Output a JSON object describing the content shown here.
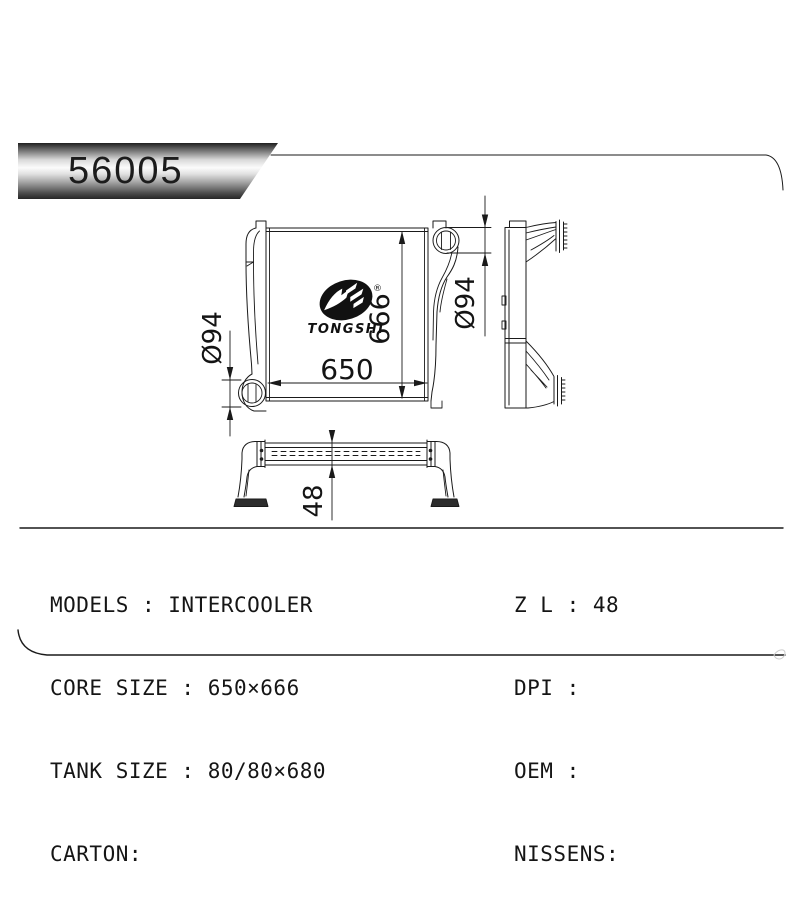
{
  "banner": {
    "part_number": "56005"
  },
  "logo": {
    "brand": "TONGSHI",
    "registered_mark": "®"
  },
  "drawing": {
    "dim_core_width": "650",
    "dim_core_height": "666",
    "dim_left_port_diameter": "Ø94",
    "dim_right_port_diameter": "Ø94",
    "dim_core_depth": "48"
  },
  "specs": {
    "left_column": [
      {
        "text": "MODELS : INTERCOOLER"
      },
      {
        "text": "CORE SIZE : 650×666"
      },
      {
        "text": "TANK SIZE : 80/80×680"
      },
      {
        "text": "CARTON:"
      }
    ],
    "right_column": [
      {
        "text": "Z L : 48"
      },
      {
        "text": "DPI :"
      },
      {
        "text": "OEM :"
      },
      {
        "text": "NISSENS:"
      }
    ]
  },
  "colors": {
    "line": "#1a1a1a",
    "banner_highlight": "#fbfbfb",
    "banner_shadow": "#222222"
  }
}
